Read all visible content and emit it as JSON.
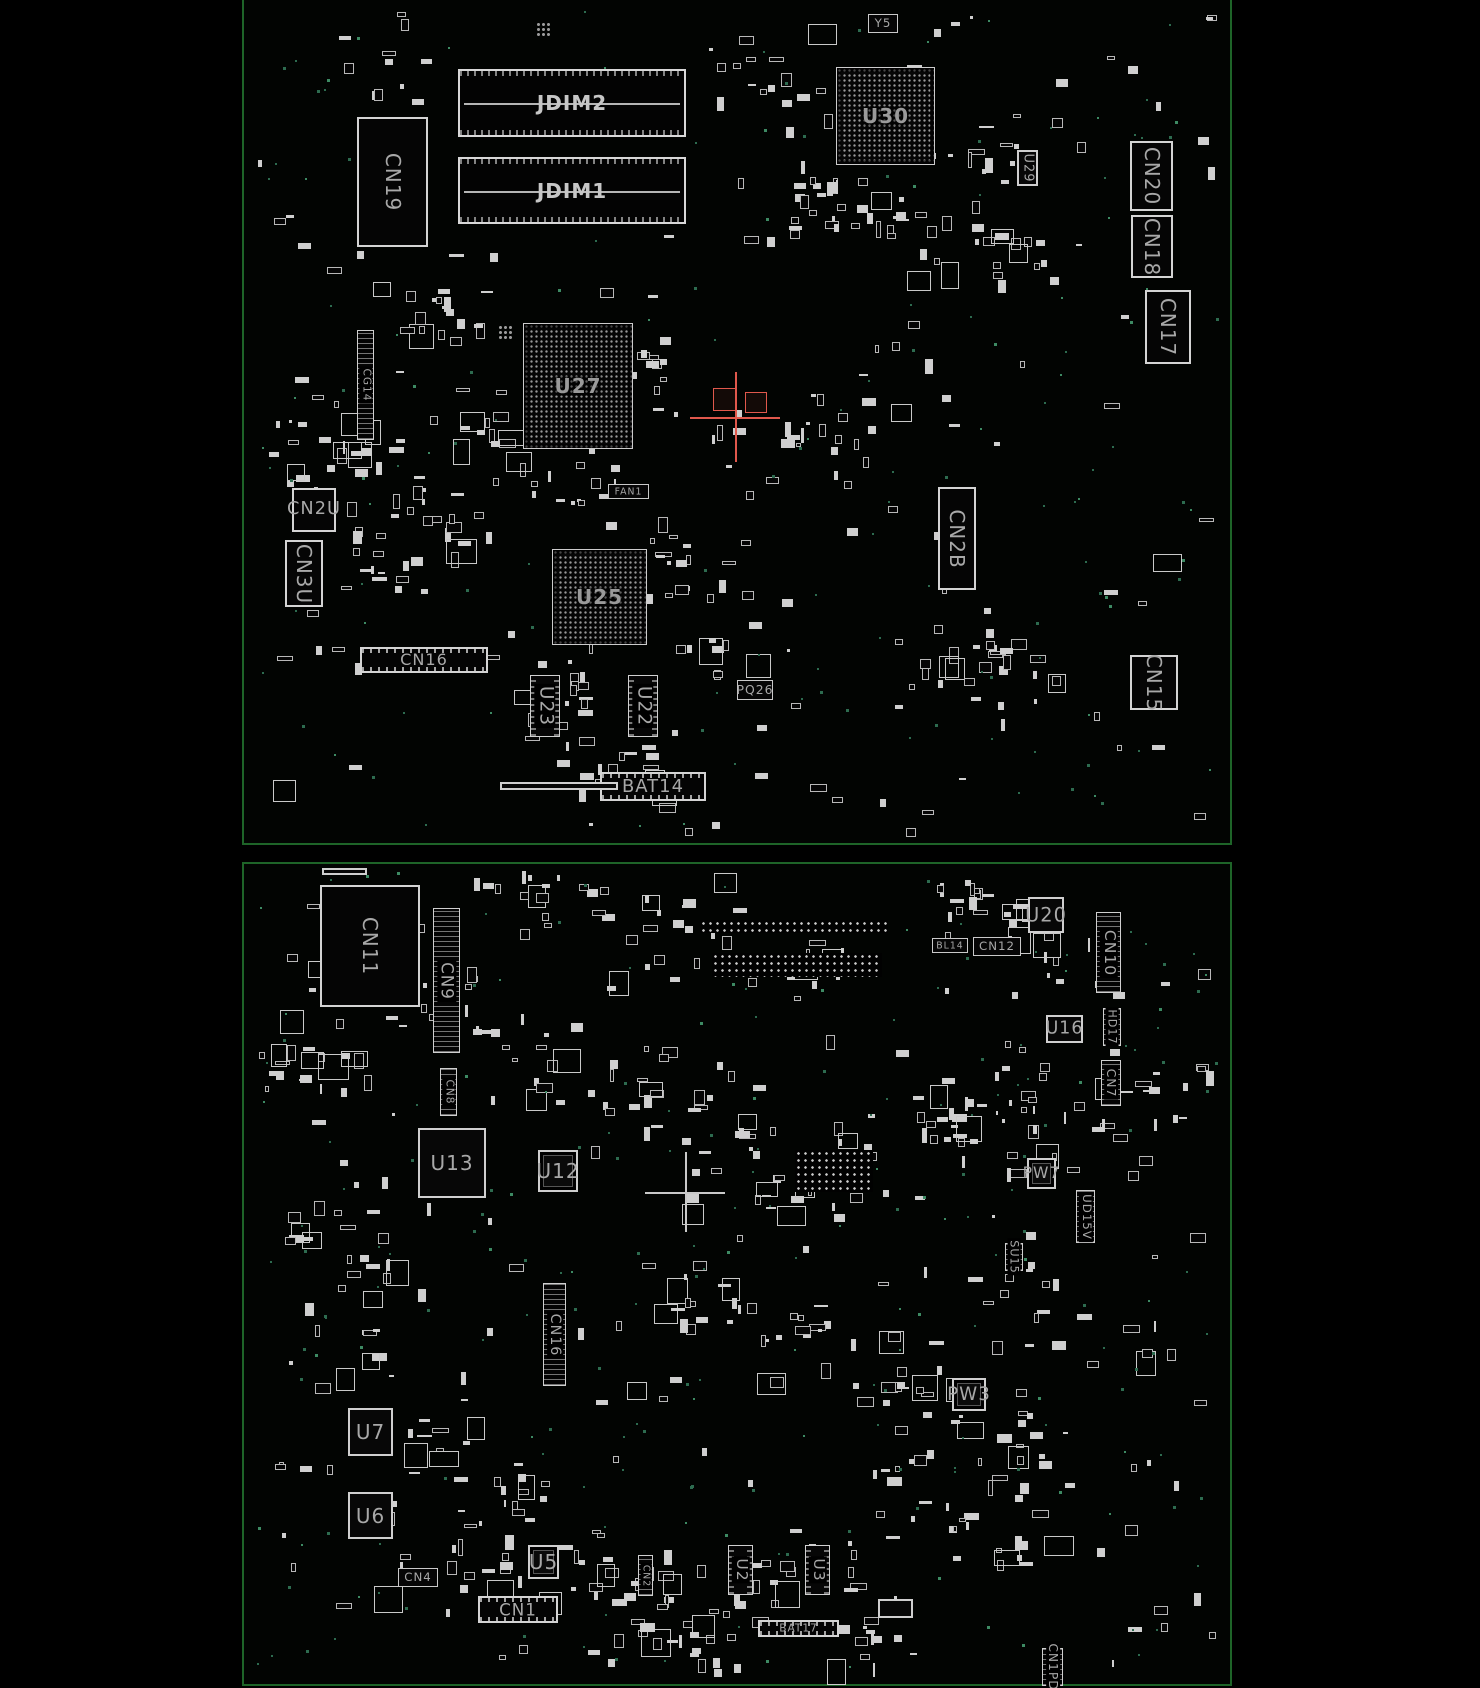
{
  "meta": {
    "view": "pcb-boardview",
    "background_color": "#000000",
    "board_outline_color": "#1e6428",
    "component_color": "#d4d4d4",
    "label_color": "#a8a8a8",
    "highlight_color": "#e0584c"
  },
  "boards": [
    {
      "name": "top-side-board",
      "x": 242,
      "y": -14,
      "width": 986,
      "height": 855,
      "components": [
        {
          "ref": "CN19",
          "type": "connector",
          "orient": "v",
          "x": 357,
          "y": 117,
          "w": 71,
          "h": 130
        },
        {
          "ref": "JDIM2",
          "type": "slot",
          "orient": "h",
          "x": 458,
          "y": 69,
          "w": 228,
          "h": 68
        },
        {
          "ref": "JDIM1",
          "type": "slot",
          "orient": "h",
          "x": 458,
          "y": 157,
          "w": 228,
          "h": 67
        },
        {
          "ref": "U30",
          "type": "bga",
          "orient": "h",
          "x": 836,
          "y": 67,
          "w": 99,
          "h": 98
        },
        {
          "ref": "Y5",
          "type": "label-box",
          "orient": "h",
          "x": 868,
          "y": 14,
          "w": 30,
          "h": 19
        },
        {
          "ref": "U29",
          "type": "box",
          "orient": "v",
          "x": 1017,
          "y": 150,
          "w": 21,
          "h": 36
        },
        {
          "ref": "CN20",
          "type": "connector",
          "orient": "v",
          "x": 1130,
          "y": 141,
          "w": 43,
          "h": 70
        },
        {
          "ref": "CN18",
          "type": "connector",
          "orient": "v",
          "x": 1131,
          "y": 215,
          "w": 42,
          "h": 63
        },
        {
          "ref": "CN17",
          "type": "connector",
          "orient": "v",
          "x": 1145,
          "y": 290,
          "w": 46,
          "h": 74
        },
        {
          "ref": "U27",
          "type": "bga",
          "orient": "h",
          "x": 523,
          "y": 323,
          "w": 110,
          "h": 126
        },
        {
          "ref": "FAN1",
          "type": "label-box",
          "orient": "h",
          "x": 608,
          "y": 484,
          "w": 41,
          "h": 15
        },
        {
          "ref": "U25",
          "type": "bga",
          "orient": "h",
          "x": 552,
          "y": 549,
          "w": 95,
          "h": 96
        },
        {
          "ref": "CN16",
          "type": "pin-connector",
          "orient": "h",
          "x": 360,
          "y": 647,
          "w": 128,
          "h": 26
        },
        {
          "ref": "U23",
          "type": "sop",
          "orient": "v",
          "x": 530,
          "y": 675,
          "w": 30,
          "h": 62
        },
        {
          "ref": "U22",
          "type": "sop",
          "orient": "v",
          "x": 628,
          "y": 675,
          "w": 30,
          "h": 62
        },
        {
          "ref": "PQ26",
          "type": "label-box",
          "orient": "h",
          "x": 737,
          "y": 680,
          "w": 36,
          "h": 20
        },
        {
          "ref": "BAT14",
          "type": "pin-connector",
          "orient": "h",
          "x": 600,
          "y": 772,
          "w": 106,
          "h": 29
        },
        {
          "ref": "",
          "type": "box",
          "orient": "h",
          "x": 500,
          "y": 782,
          "w": 118,
          "h": 8
        },
        {
          "ref": "CN2U",
          "type": "connector",
          "orient": "h",
          "x": 292,
          "y": 488,
          "w": 44,
          "h": 44
        },
        {
          "ref": "CN3U",
          "type": "connector",
          "orient": "v",
          "x": 285,
          "y": 540,
          "w": 38,
          "h": 67
        },
        {
          "ref": "CG14",
          "type": "vpin",
          "orient": "v",
          "x": 357,
          "y": 330,
          "w": 17,
          "h": 110
        },
        {
          "ref": "CN2B",
          "type": "connector",
          "orient": "v",
          "x": 938,
          "y": 487,
          "w": 38,
          "h": 103
        },
        {
          "ref": "CN15",
          "type": "connector",
          "orient": "v",
          "x": 1130,
          "y": 655,
          "w": 48,
          "h": 55
        },
        {
          "ref": "",
          "type": "fiducial",
          "orient": "h",
          "x": 536,
          "y": 22,
          "w": 14,
          "h": 14
        },
        {
          "ref": "",
          "type": "fiducial",
          "orient": "h",
          "x": 498,
          "y": 325,
          "w": 16,
          "h": 14
        },
        {
          "ref": "",
          "type": "crosshair-red",
          "orient": "h",
          "x": 690,
          "y": 372,
          "w": 90,
          "h": 90
        },
        {
          "ref": "",
          "type": "highlight-box",
          "orient": "h",
          "x": 713,
          "y": 388,
          "w": 24,
          "h": 23
        },
        {
          "ref": "",
          "type": "highlight-box",
          "orient": "h",
          "x": 745,
          "y": 392,
          "w": 22,
          "h": 21
        }
      ]
    },
    {
      "name": "bottom-side-board",
      "x": 242,
      "y": 862,
      "width": 986,
      "height": 820,
      "components": [
        {
          "ref": "CN11",
          "type": "connector",
          "orient": "v",
          "x": 320,
          "y": 885,
          "w": 100,
          "h": 122
        },
        {
          "ref": "CN9",
          "type": "vpin",
          "orient": "v",
          "x": 433,
          "y": 908,
          "w": 27,
          "h": 145
        },
        {
          "ref": "",
          "type": "box",
          "orient": "h",
          "x": 322,
          "y": 868,
          "w": 45,
          "h": 7
        },
        {
          "ref": "U20",
          "type": "box",
          "orient": "h",
          "x": 1028,
          "y": 897,
          "w": 36,
          "h": 36
        },
        {
          "ref": "BL14",
          "type": "label-box",
          "orient": "h",
          "x": 932,
          "y": 938,
          "w": 36,
          "h": 15
        },
        {
          "ref": "CN12",
          "type": "label-box",
          "orient": "h",
          "x": 973,
          "y": 937,
          "w": 48,
          "h": 19
        },
        {
          "ref": "CN10",
          "type": "vpin",
          "orient": "v",
          "x": 1096,
          "y": 912,
          "w": 25,
          "h": 81
        },
        {
          "ref": "U16",
          "type": "box",
          "orient": "h",
          "x": 1046,
          "y": 1015,
          "w": 37,
          "h": 28
        },
        {
          "ref": "HD17",
          "type": "vpin",
          "orient": "v",
          "x": 1103,
          "y": 1008,
          "w": 18,
          "h": 38
        },
        {
          "ref": "CN7",
          "type": "vpin",
          "orient": "v",
          "x": 1101,
          "y": 1060,
          "w": 20,
          "h": 46
        },
        {
          "ref": "CN8",
          "type": "vpin",
          "orient": "v",
          "x": 440,
          "y": 1068,
          "w": 17,
          "h": 48
        },
        {
          "ref": "U13",
          "type": "box",
          "orient": "h",
          "x": 418,
          "y": 1128,
          "w": 68,
          "h": 70
        },
        {
          "ref": "U12",
          "type": "qfn",
          "orient": "h",
          "x": 538,
          "y": 1150,
          "w": 40,
          "h": 42
        },
        {
          "ref": "PW7",
          "type": "qfn",
          "orient": "h",
          "x": 1027,
          "y": 1158,
          "w": 29,
          "h": 31
        },
        {
          "ref": "UD15V",
          "type": "vpin",
          "orient": "v",
          "x": 1076,
          "y": 1190,
          "w": 19,
          "h": 53
        },
        {
          "ref": "SU15",
          "type": "vpin",
          "orient": "v",
          "x": 1005,
          "y": 1243,
          "w": 18,
          "h": 28
        },
        {
          "ref": "CN16",
          "type": "vpin",
          "orient": "v",
          "x": 543,
          "y": 1283,
          "w": 23,
          "h": 103
        },
        {
          "ref": "U7",
          "type": "box",
          "orient": "h",
          "x": 348,
          "y": 1408,
          "w": 45,
          "h": 48
        },
        {
          "ref": "U6",
          "type": "box",
          "orient": "h",
          "x": 348,
          "y": 1492,
          "w": 45,
          "h": 47
        },
        {
          "ref": "U5",
          "type": "qfn",
          "orient": "h",
          "x": 528,
          "y": 1545,
          "w": 31,
          "h": 34
        },
        {
          "ref": "CN4",
          "type": "label-box",
          "orient": "h",
          "x": 398,
          "y": 1568,
          "w": 40,
          "h": 19
        },
        {
          "ref": "CN1",
          "type": "pin-connector",
          "orient": "h",
          "x": 478,
          "y": 1596,
          "w": 80,
          "h": 27
        },
        {
          "ref": "CN2",
          "type": "vpin",
          "orient": "v",
          "x": 638,
          "y": 1555,
          "w": 15,
          "h": 41
        },
        {
          "ref": "U2",
          "type": "sop",
          "orient": "v",
          "x": 728,
          "y": 1545,
          "w": 25,
          "h": 50
        },
        {
          "ref": "U3",
          "type": "sop",
          "orient": "v",
          "x": 805,
          "y": 1545,
          "w": 25,
          "h": 50
        },
        {
          "ref": "BAT17",
          "type": "pin-connector",
          "orient": "h",
          "x": 758,
          "y": 1620,
          "w": 81,
          "h": 17
        },
        {
          "ref": "",
          "type": "box",
          "orient": "h",
          "x": 878,
          "y": 1599,
          "w": 35,
          "h": 19
        },
        {
          "ref": "PW3",
          "type": "qfn",
          "orient": "h",
          "x": 952,
          "y": 1378,
          "w": 34,
          "h": 33
        },
        {
          "ref": "CN1PD",
          "type": "vpin",
          "orient": "v",
          "x": 1042,
          "y": 1648,
          "w": 21,
          "h": 38
        },
        {
          "ref": "",
          "type": "crosshair",
          "orient": "h",
          "x": 645,
          "y": 1152,
          "w": 80,
          "h": 80
        },
        {
          "ref": "",
          "type": "padrow",
          "orient": "h",
          "x": 700,
          "y": 920,
          "w": 188,
          "h": 13
        },
        {
          "ref": "",
          "type": "padrow",
          "orient": "h",
          "x": 712,
          "y": 953,
          "w": 170,
          "h": 24
        },
        {
          "ref": "",
          "type": "padrow",
          "orient": "h",
          "x": 795,
          "y": 1150,
          "w": 78,
          "h": 42
        }
      ]
    }
  ]
}
